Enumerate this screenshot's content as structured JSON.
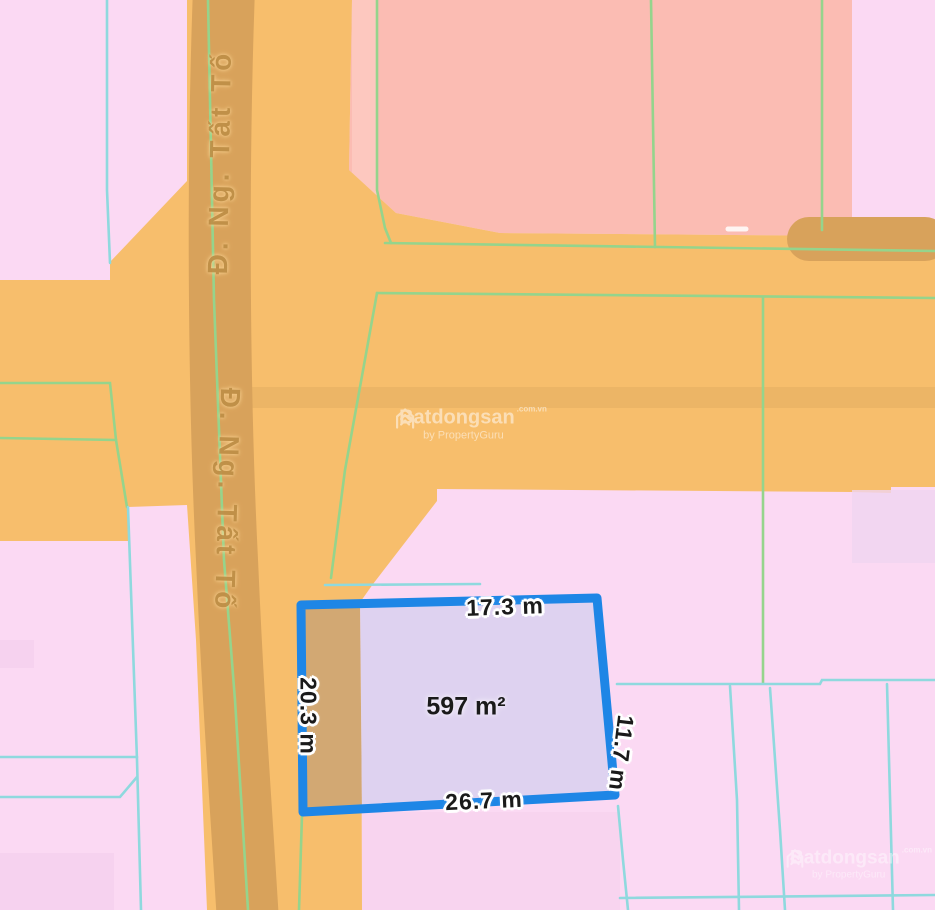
{
  "map": {
    "road_name": "Đ. Ng. Tất Tố",
    "parcel": {
      "area": "597 m²",
      "dim_top": "17.3 m",
      "dim_left": "20.3 m",
      "dim_right": "11.7 m",
      "dim_bottom": "26.7 m"
    },
    "watermark": {
      "brand": "Batdongsan",
      "suffix": ".com.vn",
      "byline": "by PropertyGuru"
    }
  },
  "colors": {
    "pink": "#fbd9f3",
    "salmon": "#fbbcb3",
    "salmon_light": "#fdc9c0",
    "orange": "#f7be6c",
    "road_dark": "#d8a25b",
    "lavender": "#ded2f0",
    "tan": "#d2a873",
    "accent_blue": "#1e86e6",
    "line_green": "#95d48c",
    "line_cyan": "#8fd9de",
    "patch_pink": "#f3cfec",
    "patch_lavender": "#f0d5f0",
    "label_dark": "#1a1a1a",
    "road_text": "#bf8f47"
  }
}
